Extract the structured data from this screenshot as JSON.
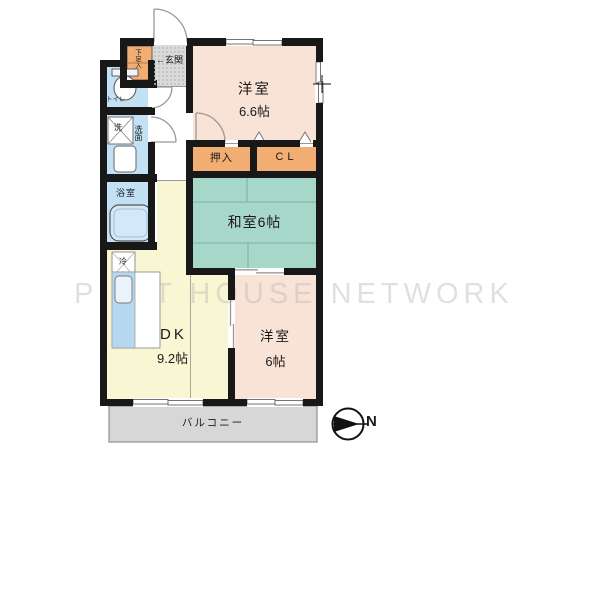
{
  "watermark": "PITAT HOUSE NETWORK",
  "rooms": {
    "western1": {
      "label": "洋室",
      "size": "6.6帖"
    },
    "japanese": {
      "label": "和室6帖"
    },
    "western2": {
      "label": "洋室",
      "size": "6帖"
    },
    "dk": {
      "label": "DK",
      "size": "9.2帖"
    },
    "balcony": {
      "label": "バルコニー"
    },
    "entrance": {
      "label": "玄関",
      "arrow": "←"
    },
    "toilet": {
      "label": "トイレ"
    },
    "washroom": {
      "label": "洗面"
    },
    "washer": {
      "label": "洗"
    },
    "bathroom": {
      "label": "浴室"
    },
    "shoe_cabinet": {
      "label": "下足入"
    },
    "oshiire": {
      "label": "押入"
    },
    "closet": {
      "label": "CL"
    },
    "fridge": {
      "label": "冷"
    }
  },
  "compass": {
    "label": "N"
  },
  "colors": {
    "western_room": "#f9e2d6",
    "japanese_room": "#a7d7c9",
    "dk_room": "#f8f6d3",
    "closet": "#f1ad72",
    "water_room": "#c3e1f5",
    "entrance_floor": "#dadada",
    "balcony": "#d7d7d7",
    "wall": "#181818"
  }
}
